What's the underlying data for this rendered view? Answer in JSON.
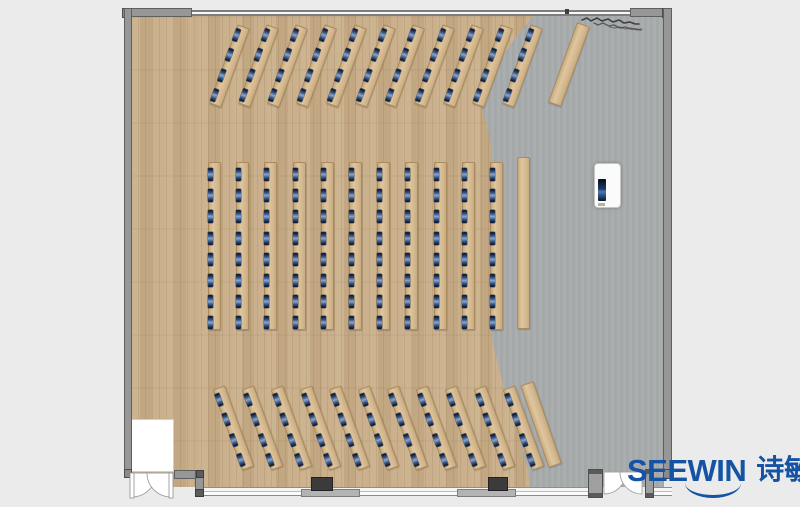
{
  "branding": {
    "logo_latin": "SEEWIN",
    "logo_cjk": "诗敏",
    "logo_color": "#1553a4"
  },
  "palette": {
    "page_background": "#ebebeb",
    "wood_floor": "#c9ae89",
    "gray_floor": "#a7abab",
    "wall_gray": "#979797",
    "desk_wood": "#d5b990",
    "seat_monitor_blue": "#33507e",
    "structural_column_dark": "#3b3b3b"
  },
  "room": {
    "type": "lecture-classroom floor plan",
    "sections": [
      {
        "id": "top",
        "desk_rows": 11,
        "seats_per_row": 4,
        "side_tables": 1,
        "rotation_deg": 20
      },
      {
        "id": "middle",
        "desk_rows": 11,
        "seats_per_row": 8,
        "side_tables": 1,
        "rotation_deg": 0
      },
      {
        "id": "bottom",
        "desk_rows": 11,
        "seats_per_row": 4,
        "side_tables": 1,
        "rotation_deg": -20
      }
    ],
    "total_seats": 176,
    "fixtures": [
      "double-door-bottom-left",
      "double-door-bottom-right",
      "glass-wall-bottom",
      "structural-columns-2",
      "podium",
      "wall-scribble-top-right",
      "entry-alcove-bottom-left"
    ]
  }
}
